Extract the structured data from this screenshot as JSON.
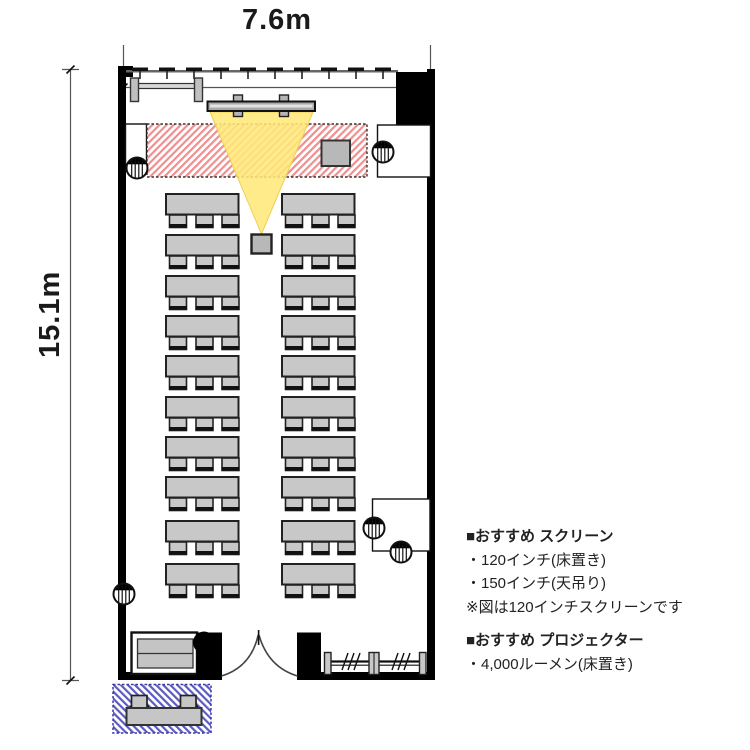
{
  "page": {
    "title": "seminar room floor plan"
  },
  "dimensions": {
    "width_label": "7.6m",
    "height_label": "15.1m"
  },
  "recommendations": {
    "screen": {
      "heading": "■おすすめ スクリーン",
      "items": [
        "・120インチ(床置き)",
        "・150インチ(天吊り)",
        "※図は120インチスクリーンです"
      ]
    },
    "projector": {
      "heading": "■おすすめ プロジェクター",
      "items": [
        "・4,000ルーメン(床置き)"
      ]
    }
  },
  "floorplan": {
    "room": {
      "width_m": 7.6,
      "depth_m": 15.1
    },
    "tables": {
      "rows": 10,
      "columns": 2,
      "chairs_per_table": 3,
      "total_seats": 60
    },
    "row_y": [
      194,
      235,
      276,
      316,
      356,
      397,
      437,
      477,
      521,
      564
    ],
    "col_x": [
      166,
      282
    ],
    "speakers": [
      [
        137,
        168
      ],
      [
        383,
        152
      ],
      [
        374,
        528
      ],
      [
        401,
        552
      ],
      [
        124,
        594
      ]
    ],
    "window_ticks": {
      "count": 10,
      "start_x": 140,
      "spacing": 27
    },
    "colors": {
      "wall": "#000000",
      "furniture_gray": "#c8c8c8",
      "projection_cone": "#ffe87a",
      "stage_hatch_red": "#ef8f8f",
      "entry_hatch_blue": "#5b5bc0"
    }
  }
}
